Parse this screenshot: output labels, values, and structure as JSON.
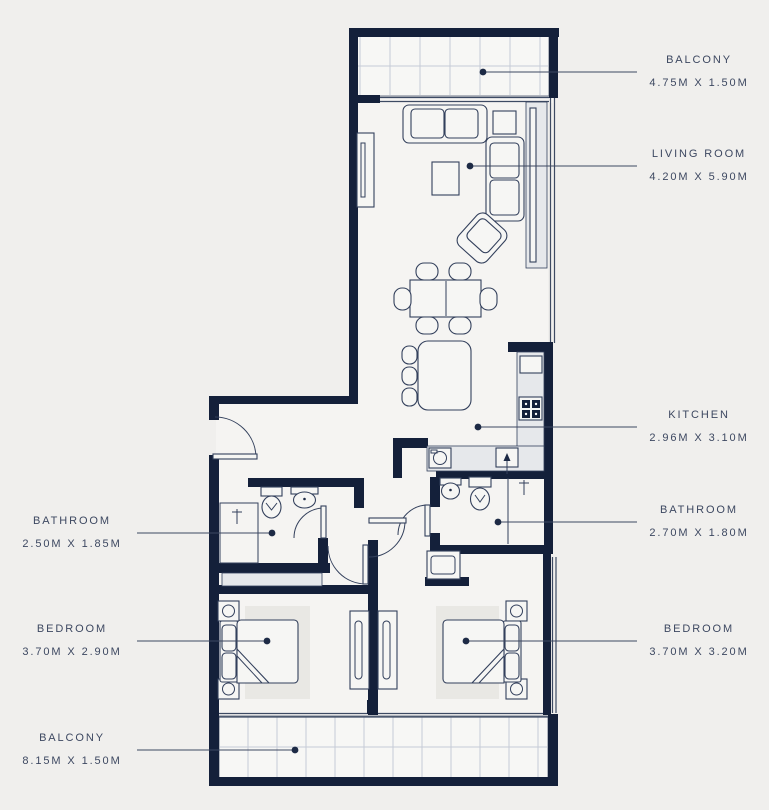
{
  "plan_title": "Two Bedroom Apartment Floor Plan",
  "colors": {
    "background": "#f0efed",
    "wall": "#14203a",
    "line": "#33405c",
    "label_text": "#3d4861",
    "tile_grid": "#c5cbd6"
  },
  "rooms": [
    {
      "name": "BALCONY",
      "dims": "4.75M X 1.50M",
      "side": "right"
    },
    {
      "name": "LIVING ROOM",
      "dims": "4.20M X 5.90M",
      "side": "right"
    },
    {
      "name": "KITCHEN",
      "dims": "2.96M X 3.10M",
      "side": "right"
    },
    {
      "name": "BATHROOM",
      "dims": "2.70M X 1.80M",
      "side": "right"
    },
    {
      "name": "BEDROOM",
      "dims": "3.70M X 3.20M",
      "side": "right"
    },
    {
      "name": "BATHROOM",
      "dims": "2.50M X 1.85M",
      "side": "left"
    },
    {
      "name": "BEDROOM",
      "dims": "3.70M X 2.90M",
      "side": "left"
    },
    {
      "name": "BALCONY",
      "dims": "8.15M X 1.50M",
      "side": "left"
    }
  ]
}
